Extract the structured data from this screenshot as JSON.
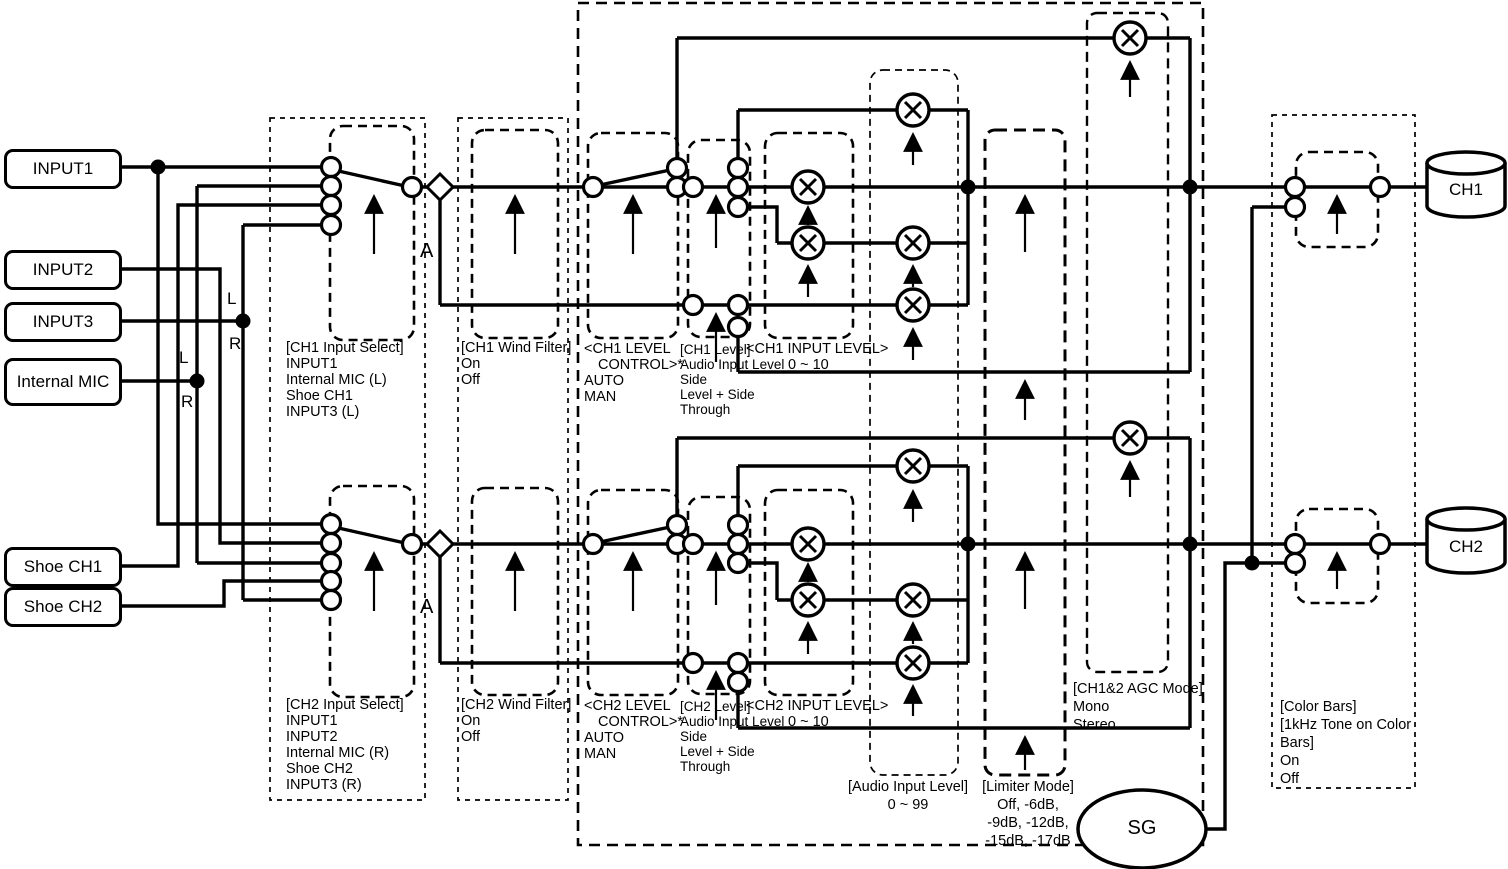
{
  "inputs": {
    "input1": "INPUT1",
    "input2": "INPUT2",
    "input3": "INPUT3",
    "internal_mic": "Internal MIC",
    "shoe_ch1": "Shoe CH1",
    "shoe_ch2": "Shoe CH2"
  },
  "outputs": {
    "ch1": "CH1",
    "ch2": "CH2",
    "sg": "SG"
  },
  "markers": {
    "tap_a_ch1": "A",
    "tap_a_ch2": "A",
    "mic_l": "L",
    "mic_r": "R",
    "input3_l": "L",
    "input3_r": "R"
  },
  "labels": {
    "ch1_select": [
      "[CH1 Input Select]",
      "INPUT1",
      "Internal MIC (L)",
      "Shoe CH1",
      "INPUT3 (L)"
    ],
    "ch1_wind": [
      "[CH1 Wind Filter]",
      "On",
      "Off"
    ],
    "ch1_lvlctl": [
      "<CH1 LEVEL",
      "CONTROL>*",
      "AUTO",
      "MAN"
    ],
    "ch1_level": [
      "[CH1 Level]",
      "Audio Input Level",
      "Side",
      "Level + Side",
      "Through"
    ],
    "ch1_inlvl": [
      "<CH1 INPUT LEVEL>",
      "0 ~ 10"
    ],
    "ch2_select": [
      "[CH2 Input Select]",
      "INPUT1",
      "INPUT2",
      "Internal MIC (R)",
      "Shoe CH2",
      "INPUT3 (R)"
    ],
    "ch2_wind": [
      "[CH2 Wind Filter]",
      "On",
      "Off"
    ],
    "ch2_lvlctl": [
      "<CH2 LEVEL",
      "CONTROL>*",
      "AUTO",
      "MAN"
    ],
    "ch2_level": [
      "[CH2 Level]",
      "Audio Input Level",
      "Side",
      "Level + Side",
      "Through"
    ],
    "ch2_inlvl": [
      "<CH2 INPUT LEVEL>",
      "0 ~ 10"
    ],
    "audio_input_level": [
      "[Audio Input Level]",
      "0 ~ 99"
    ],
    "limiter_mode": [
      "[Limiter Mode]",
      "Off, -6dB,",
      "-9dB, -12dB,",
      "-15dB, -17dB"
    ],
    "agc_mode": [
      "[CH1&2 AGC Mode]",
      "Mono",
      "Stereo"
    ],
    "color_bars": [
      "[Color Bars]",
      "[1kHz Tone on Color",
      "Bars]",
      "On",
      "Off"
    ]
  },
  "colors": {
    "line": "#000000",
    "background": "#ffffff"
  }
}
